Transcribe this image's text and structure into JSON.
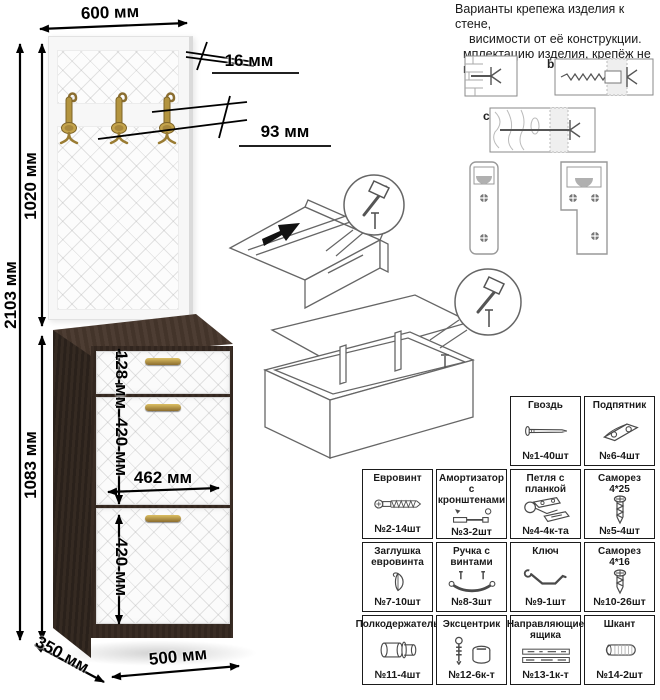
{
  "note": {
    "lines": [
      "Варианты крепежа изделия к стене,",
      "висимости от её конструкции.",
      "мплектацию изделия, крепёж  не",
      "ит."
    ]
  },
  "wall_mount": {
    "label_b": "b",
    "label_c": "c"
  },
  "dimensions": {
    "top_width": "600 мм",
    "panel_thickness": "16 мм",
    "hook_offset": "93 мм",
    "total_height": "2103 мм",
    "panel_height": "1020 мм",
    "cabinet_height": "1083 мм",
    "drawer_height": "128 мм",
    "upper_door_height": "420 мм",
    "door_width": "462 мм",
    "lower_door_height": "420 мм",
    "depth": "350 мм",
    "cabinet_width": "500 мм"
  },
  "colors": {
    "cabinet_dark": "#32261f",
    "door_white": "#fbfbfb",
    "hook_brass": "#b09040",
    "line_black": "#000000"
  },
  "parts_table": {
    "row1": [
      {
        "name": "Гвоздь",
        "count": "№1-40шт"
      },
      {
        "name": "Подпятник",
        "count": "№6-4шт"
      }
    ],
    "row2": [
      {
        "name": "Евровинт",
        "count": "№2-14шт"
      },
      {
        "name": "Амортизатор с кронштенами",
        "count": "№3-2шт"
      },
      {
        "name": "Петля с планкой",
        "count": "№4-4к-та"
      },
      {
        "name": "Саморез 4*25",
        "count": "№5-4шт"
      }
    ],
    "row3": [
      {
        "name": "Заглушка евровинта",
        "count": "№7-10шт"
      },
      {
        "name": "Ручка с винтами",
        "count": "№8-3шт"
      },
      {
        "name": "Ключ",
        "count": "№9-1шт"
      },
      {
        "name": "Саморез 4*16",
        "count": "№10-26шт"
      }
    ],
    "row4": [
      {
        "name": "Полкодержатель",
        "count": "№11-4шт"
      },
      {
        "name": "Эксцентрик",
        "count": "№12-6к-т"
      },
      {
        "name": "Направляющие ящика",
        "count": "№13-1к-т"
      },
      {
        "name": "Шкант",
        "count": "№14-2шт"
      }
    ]
  }
}
